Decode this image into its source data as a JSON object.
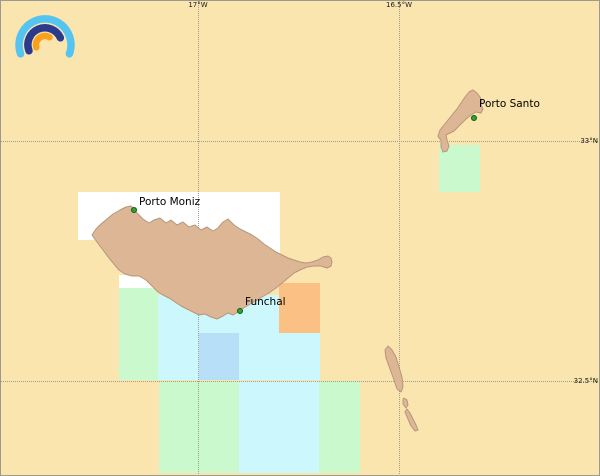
{
  "map": {
    "background_color": "#FAE5AF",
    "frame_color": "#9A9A8E",
    "grid": {
      "line_color": "#9C9C91",
      "label_color": "#1A1A1A",
      "meridians": [
        {
          "id": "meridian-17w",
          "label": "17°W",
          "x": 198
        },
        {
          "id": "meridian-16-5w",
          "label": "16.5°W",
          "x": 399
        }
      ],
      "parallels": [
        {
          "id": "parallel-33n",
          "label": "33°N",
          "y": 141
        },
        {
          "id": "parallel-32-5n",
          "label": "32.5°N",
          "y": 381
        }
      ]
    },
    "tiles": [
      {
        "id": "tile-cyan-madeira-south",
        "x": 158,
        "y": 295,
        "w": 162,
        "h": 85,
        "color": "#CBF7FD"
      },
      {
        "id": "tile-white-madeira-northwest",
        "x": 78,
        "y": 192,
        "w": 119,
        "h": 48,
        "color": "#FFFFFF"
      },
      {
        "id": "tile-white-madeira-north",
        "x": 197,
        "y": 192,
        "w": 83,
        "h": 64,
        "color": "#FFFFFF"
      },
      {
        "id": "tile-white-madeira-southwest",
        "x": 119,
        "y": 275,
        "w": 39,
        "h": 13,
        "color": "#FFFFFF"
      },
      {
        "id": "tile-green-madeira-west",
        "x": 119,
        "y": 288,
        "w": 39,
        "h": 92,
        "color": "#C9F9CD"
      },
      {
        "id": "tile-orange-madeira-east",
        "x": 279,
        "y": 283,
        "w": 41,
        "h": 50,
        "color": "#FBC083"
      },
      {
        "id": "tile-blue-madeira-south",
        "x": 199,
        "y": 333,
        "w": 40,
        "h": 47,
        "color": "#B7DFF7"
      },
      {
        "id": "tile-green-south-west",
        "x": 159,
        "y": 381,
        "w": 80,
        "h": 92,
        "color": "#C9F9CD"
      },
      {
        "id": "tile-cyan-south",
        "x": 239,
        "y": 381,
        "w": 80,
        "h": 92,
        "color": "#CBF7FD"
      },
      {
        "id": "tile-green-south-east",
        "x": 319,
        "y": 381,
        "w": 41,
        "h": 92,
        "color": "#C9F9CD"
      },
      {
        "id": "tile-green-porto-santo",
        "x": 439,
        "y": 145,
        "w": 41,
        "h": 47,
        "color": "#C9F9CD"
      }
    ],
    "islands": {
      "fill": "#DDB795",
      "stroke": "#B5967A",
      "shapes": [
        {
          "id": "island-madeira",
          "points": "92,235 96,229 101,224 107,219 113,214 120,210 126,207 131,206 134,209 138,214 143,219 149,223 154,220 160,218 166,223 171,220 177,225 183,222 189,227 195,225 201,230 207,227 213,231 218,228 223,222 228,219 234,225 240,229 246,232 252,235 258,239 264,244 270,248 276,252 282,255 288,258 294,260 300,262 306,263 312,262 318,260 323,257 328,256 331,258 332,262 331,266 327,268 321,266 314,266 307,267 300,270 294,273 288,278 282,283 276,288 269,293 262,297 254,302 247,306 242,309 238,312 233,315 228,313 223,316 217,319 211,317 205,314 199,315 193,312 187,309 181,306 175,302 169,298 163,295 158,292 152,286 146,280 139,276 132,276 125,274 119,270 114,264 109,258 103,250 97,242"
        },
        {
          "id": "island-porto-santo",
          "points": "438,136 440,130 444,125 448,120 452,115 457,109 461,103 465,97 469,92 473,90 477,93 480,97 482,101 481,105 483,109 481,113 476,112 471,115 466,119 462,123 458,127 454,131 450,133 446,135 447,140 449,146 447,151 443,152 441,147 441,140 439,138"
        },
        {
          "id": "island-deserta-north",
          "points": "388,346 392,350 396,357 399,367 402,377 403,387 401,392 397,389 394,380 390,369 386,358 385,350"
        },
        {
          "id": "island-deserta-middle",
          "points": "404,398 407,400 408,405 406,408 403,404 403,400"
        },
        {
          "id": "island-deserta-south",
          "points": "407,409 410,413 413,419 416,425 418,430 415,431 411,426 408,419 405,412"
        }
      ]
    },
    "places": [
      {
        "id": "porto-moniz",
        "label": "Porto Moniz",
        "dot_x": 131,
        "dot_y": 207,
        "label_x": 139,
        "label_y": 196
      },
      {
        "id": "funchal",
        "label": "Funchal",
        "dot_x": 237,
        "dot_y": 308,
        "label_x": 245,
        "label_y": 296
      },
      {
        "id": "porto-santo",
        "label": "Porto Santo",
        "dot_x": 471,
        "dot_y": 115,
        "label_x": 479,
        "label_y": 98
      }
    ],
    "place_marker": {
      "fill": "#2FA52F",
      "stroke": "#135813"
    },
    "logo": {
      "x": 6,
      "y": 8,
      "w": 76,
      "h": 56,
      "arcs": [
        {
          "id": "logo-outer-arc",
          "path": "M 14.6,45.9 A 26,26 0 1 1 63.4,45.9",
          "color": "#56C4F1",
          "width": 7.5
        },
        {
          "id": "logo-middle-arc",
          "path": "M 23,42.8 A 17,17 0 0 1 54.4,29.8",
          "color": "#2A3B8E",
          "width": 7.5
        },
        {
          "id": "logo-inner-arc",
          "path": "M 30.3,39.3 A 9,9 0 0 1 43.5,29.2",
          "color": "#F9A11C",
          "width": 6.5
        }
      ]
    }
  }
}
